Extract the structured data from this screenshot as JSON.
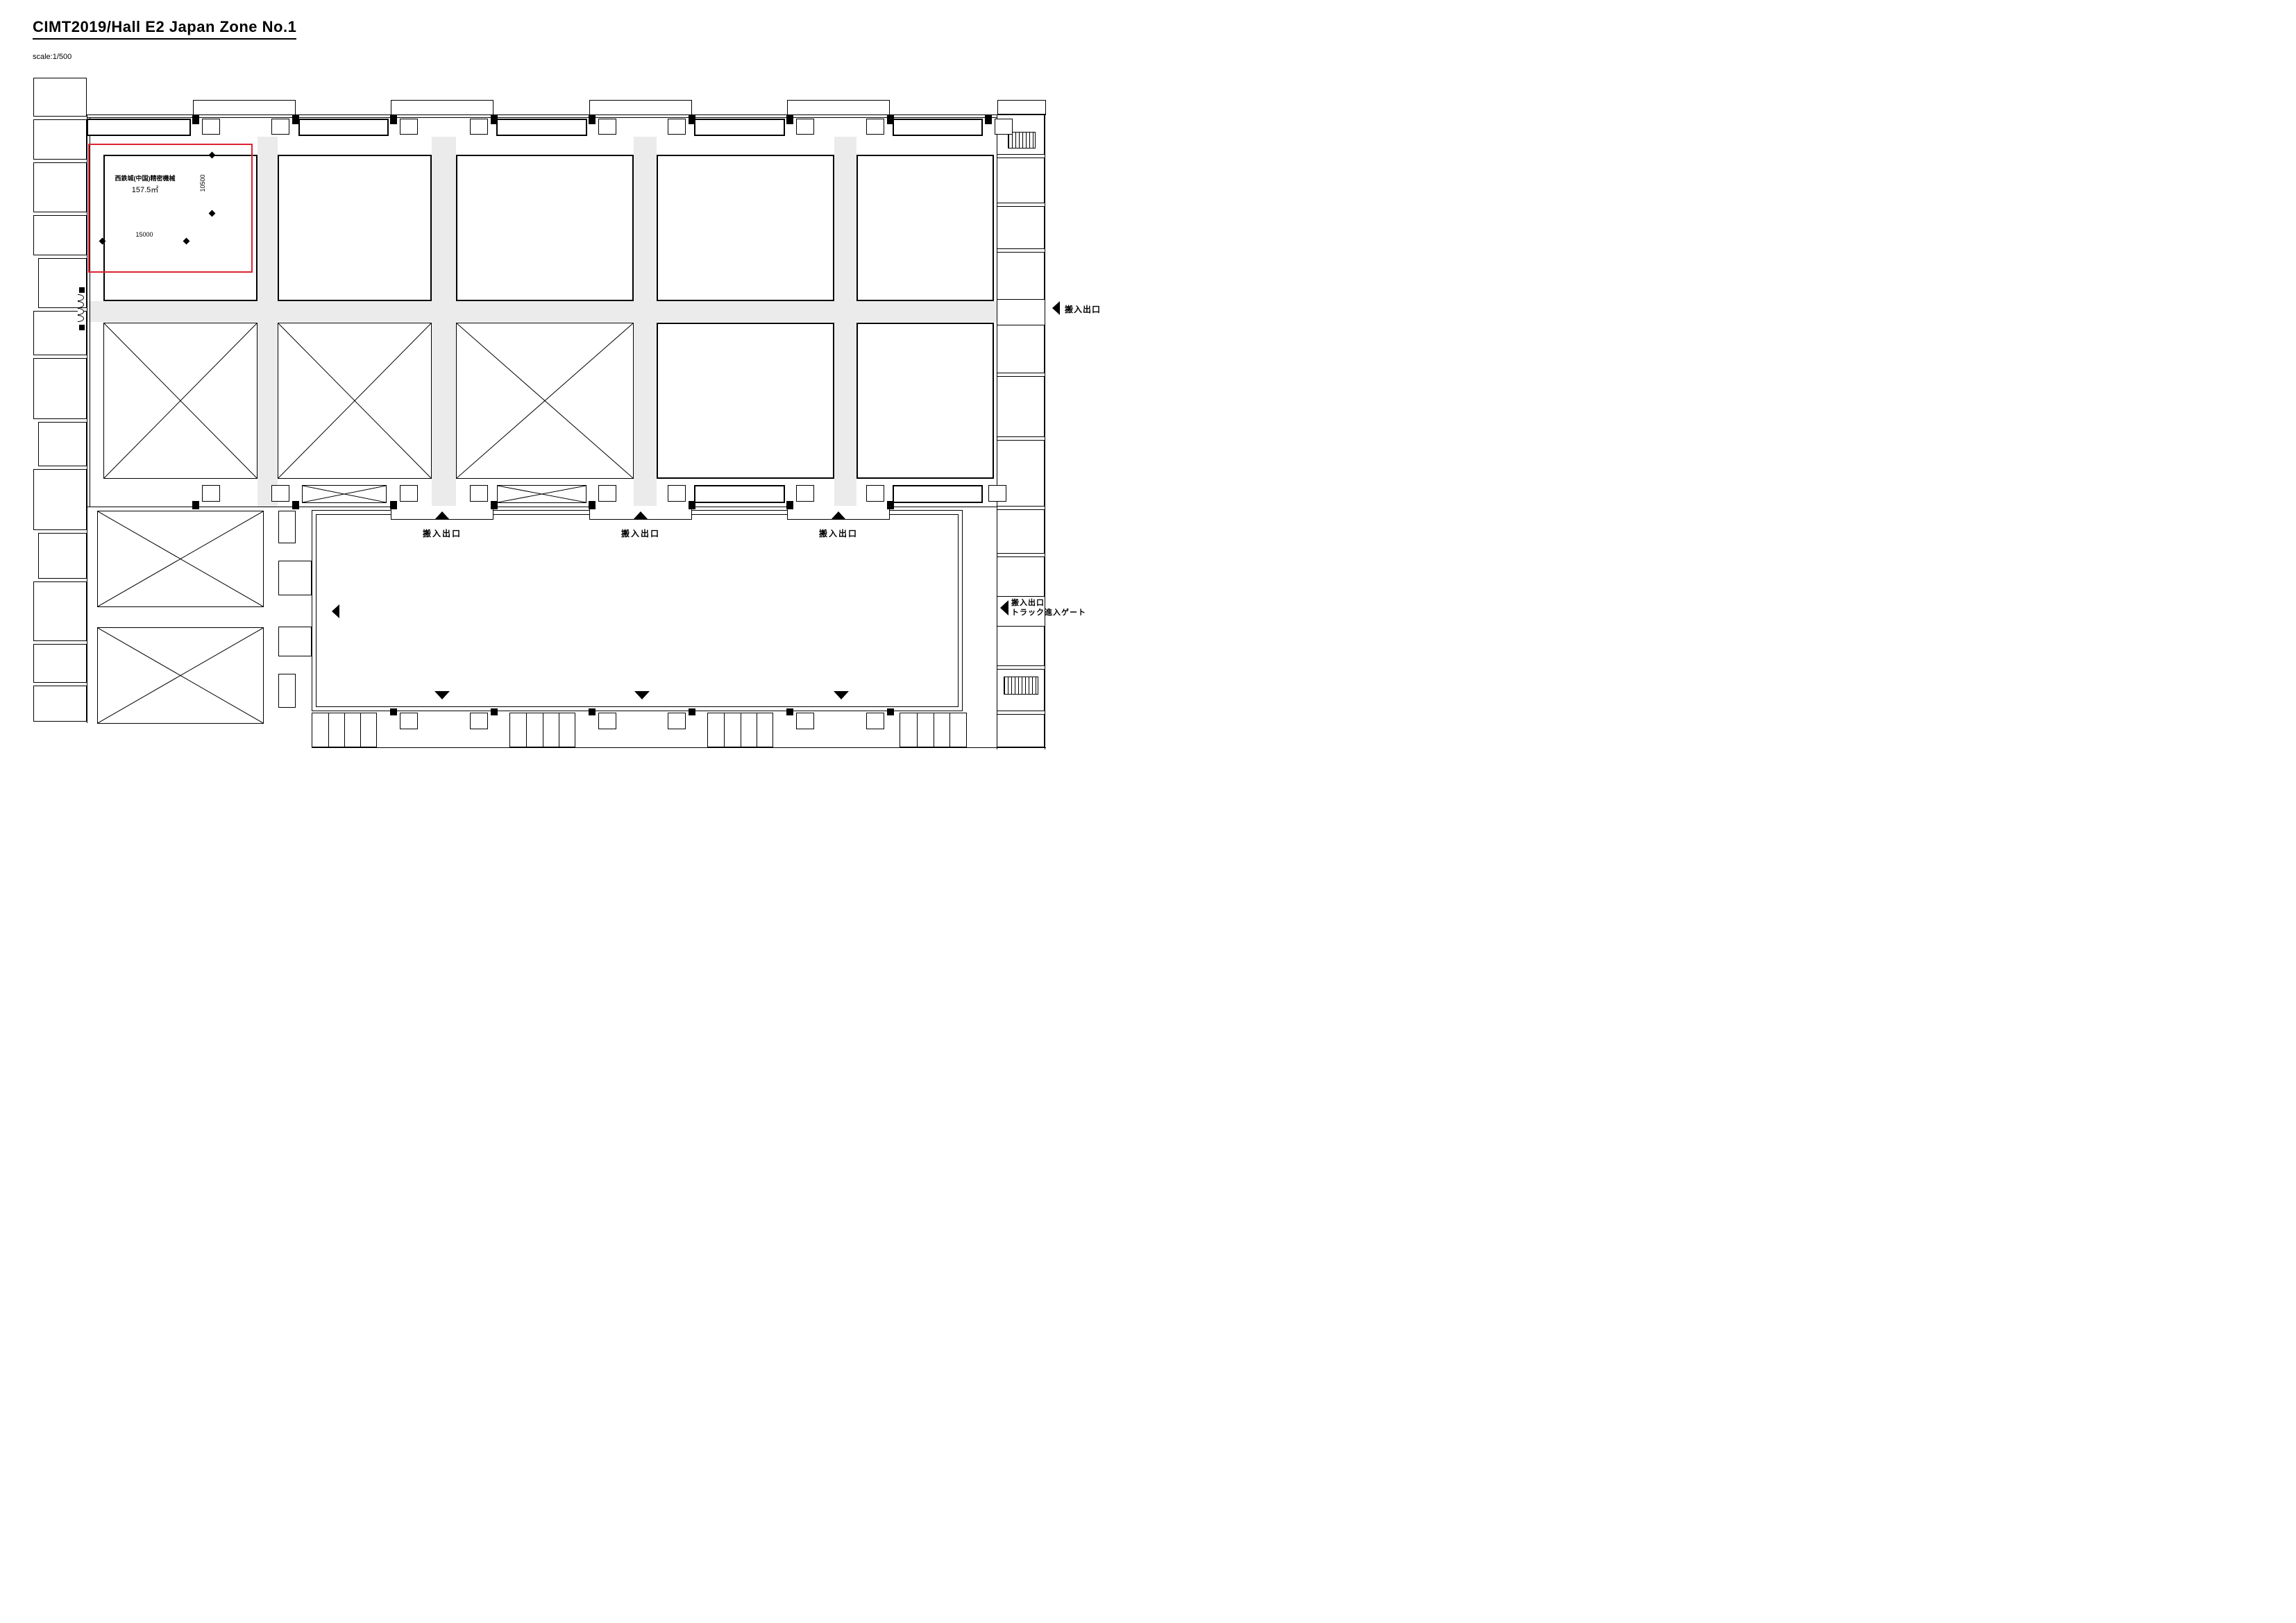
{
  "header": {
    "title": "CIMT2019/Hall E2 Japan Zone No.1",
    "scale_note": "scale:1/500"
  },
  "highlight_booth": {
    "exhibitor": "西鉄城(中国)精密機械",
    "area": "157.5㎡",
    "dim_width_mm": "15000",
    "dim_height_mm": "10500"
  },
  "labels": {
    "load_entrance": "搬入出口",
    "truck_gate": "トラック進入ゲート"
  },
  "colors": {
    "highlight_red": "#dc2330",
    "aisle_gray": "#ebebeb",
    "line_black": "#000000"
  }
}
